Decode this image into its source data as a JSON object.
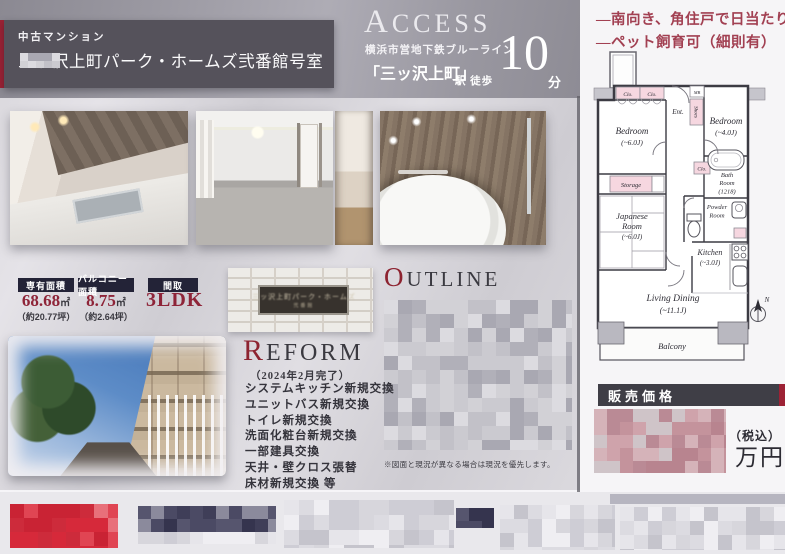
{
  "colors": {
    "accent_red": "#9d2235",
    "feature_red": "#a24052",
    "header_gray": "#55525b",
    "label_navy": "#232337",
    "value_red": "#8e2438"
  },
  "header": {
    "category": "中古マンション",
    "title": "三ッ沢上町パーク・ホームズ弐番館",
    "room_suffix": "号室",
    "room_number_redacted": true
  },
  "access": {
    "initial": "A",
    "rest": "CCESS",
    "subtitle": "横浜市営地下鉄ブルーライン",
    "station": "「三ッ沢上町」",
    "walk": "駅 徒歩",
    "minutes": "10",
    "unit": "分"
  },
  "features": {
    "line1": "―南向き、角住戸で日当たり良好",
    "line2": "―ペット飼育可（細則有）"
  },
  "stats": {
    "items": [
      {
        "label": "専有面積",
        "value": "68.68",
        "unit": "㎡",
        "tsubo": "（約20.77坪）"
      },
      {
        "label": "バルコニー面積",
        "value": "8.75",
        "unit": "㎡",
        "tsubo": "（約2.64坪）"
      },
      {
        "label": "間取",
        "value": "3LDK",
        "unit": "",
        "tsubo": ""
      }
    ]
  },
  "nameplate": {
    "line1": "三ッ沢上町パーク・ホームズ",
    "line2": "弐番館"
  },
  "outline": {
    "initial": "O",
    "rest": "UTLINE",
    "content_redacted": true
  },
  "reform": {
    "initial": "R",
    "rest": "EFORM",
    "completed": "（2024年2月完了）",
    "items": [
      "システムキッチン新規交換",
      "ユニットバス新規交換",
      "トイレ新規交換",
      "洗面化粧台新規交換",
      "一部建具交換",
      "天井・壁クロス張替",
      "床材新規交換 等"
    ]
  },
  "footnote": "※図面と現況が異なる場合は現況を優先します。",
  "floorplan": {
    "clo": "Clo.",
    "mb": "MB",
    "ent": "Ent.",
    "shoes": "Shoes",
    "storage": "Storage",
    "bedroom": "Bedroom",
    "bedroom1_size": "(~6.0J)",
    "bedroom2_size": "(~4.0J)",
    "japanese1": "Japanese",
    "japanese2": "Room",
    "japanese_size": "(~6.0J)",
    "bath1": "Bath",
    "bath2": "Room",
    "bath_size": "(1218)",
    "powder1": "Powder",
    "powder2": "Room",
    "kitchen": "Kitchen",
    "kitchen_size": "(~3.0J)",
    "living": "Living Dining",
    "living_size": "(~11.1J)",
    "balcony": "Balcony",
    "north": "N"
  },
  "price": {
    "label": "販売価格",
    "tax": "（税込）",
    "unit": "万円",
    "amount_redacted": true
  },
  "footer": {
    "redacted": true
  },
  "mosaics": {
    "gray": [
      "#c2c1c8",
      "#b1b0b9",
      "#d2d1d6",
      "#a9a8b2",
      "#cbcad0",
      "#dcdbe0"
    ],
    "light": [
      "#dcdbe1",
      "#cecdd5",
      "#e6e5ea",
      "#c5c4cc",
      "#d7d6dc",
      "#efeef2"
    ],
    "red_text": [
      "#c4939c",
      "#b8848f",
      "#cfa3ab",
      "#ba8a95",
      "#d5b3b9",
      "#cfc4c8"
    ],
    "footer_red": [
      "#d6293a",
      "#c92334",
      "#e04553",
      "#cd2b3b",
      "#e8707a"
    ],
    "footer_navy": [
      "#3f3e58",
      "#4b4a64",
      "#56556e",
      "#35344e",
      "#8b8a9c"
    ]
  }
}
